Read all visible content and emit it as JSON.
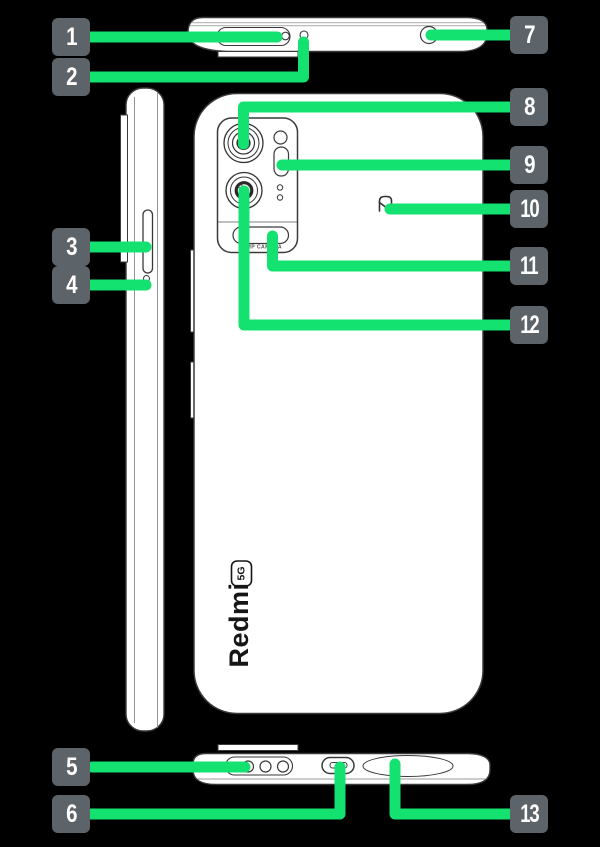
{
  "colors": {
    "background": "#000000",
    "accent_green": "#13e170",
    "badge_bg": "#5c6369",
    "badge_text": "#ffffff",
    "device_outline": "#3a3a3a",
    "device_fill": "#ffffff"
  },
  "callouts": [
    {
      "label": "1"
    },
    {
      "label": "2"
    },
    {
      "label": "3"
    },
    {
      "label": "4"
    },
    {
      "label": "5"
    },
    {
      "label": "6"
    },
    {
      "label": "7"
    },
    {
      "label": "8"
    },
    {
      "label": "9"
    },
    {
      "label": "10"
    },
    {
      "label": "11"
    },
    {
      "label": "12"
    },
    {
      "label": "13"
    }
  ],
  "device_text": {
    "brand": "Redmi",
    "badge_5g": "5G",
    "camera_label": "48MP CAMERA"
  },
  "icons": {
    "nfc": "nfc-n-mark-icon"
  }
}
